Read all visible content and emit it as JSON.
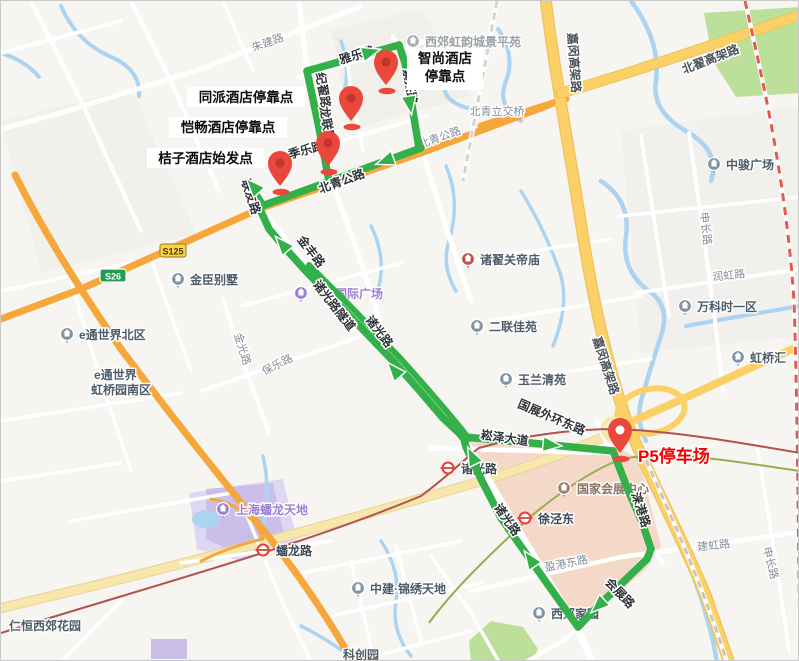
{
  "map_title": "hotel-shuttle-route-map",
  "route": {
    "color": "#33b04a",
    "width": 7.5,
    "lines": [
      {
        "name": "beiqing-gonglu-segment",
        "w": 7.5,
        "points": [
          [
            420,
            147
          ],
          [
            258,
            206
          ]
        ]
      },
      {
        "name": "start-stub",
        "w": 6.5,
        "points": [
          [
            262,
            204
          ],
          [
            248,
            181
          ]
        ]
      },
      {
        "name": "jizhai-road-segment",
        "w": 7.5,
        "points": [
          [
            328,
            180
          ],
          [
            317,
            122
          ],
          [
            306,
            70
          ]
        ]
      },
      {
        "name": "yale-road-segment",
        "w": 7.5,
        "points": [
          [
            306,
            70
          ],
          [
            398,
            44
          ]
        ]
      },
      {
        "name": "zixing-road-segment",
        "w": 7.5,
        "points": [
          [
            398,
            44
          ],
          [
            404,
            62
          ],
          [
            418,
            147
          ]
        ]
      },
      {
        "name": "zhuguang-corridor-down",
        "w": 7.5,
        "points": [
          [
            258,
            206
          ],
          [
            268,
            228
          ],
          [
            284,
            247
          ],
          [
            303,
            268
          ],
          [
            324,
            290
          ],
          [
            347,
            313
          ],
          [
            370,
            337
          ],
          [
            394,
            362
          ],
          [
            418,
            389
          ],
          [
            442,
            417
          ],
          [
            458,
            432
          ],
          [
            463,
            438
          ]
        ]
      },
      {
        "name": "zhuguang-corridor-parallel",
        "w": 6,
        "points": [
          [
            308,
            264
          ],
          [
            330,
            286
          ],
          [
            353,
            309
          ],
          [
            376,
            333
          ],
          [
            400,
            358
          ],
          [
            424,
            385
          ],
          [
            448,
            413
          ],
          [
            462,
            430
          ],
          [
            468,
            438
          ]
        ]
      },
      {
        "name": "songze-avenue-segment",
        "w": 7.5,
        "points": [
          [
            463,
            436
          ],
          [
            530,
            442
          ],
          [
            612,
            450
          ]
        ]
      },
      {
        "name": "laigang-road-segment",
        "w": 7.5,
        "points": [
          [
            612,
            450
          ],
          [
            627,
            489
          ],
          [
            641,
            521
          ],
          [
            650,
            548
          ]
        ]
      },
      {
        "name": "huizhan-road-segment",
        "w": 7.5,
        "points": [
          [
            650,
            548
          ],
          [
            646,
            558
          ],
          [
            618,
            585
          ],
          [
            595,
            607
          ],
          [
            577,
            626
          ]
        ]
      },
      {
        "name": "zhuguang-road-return",
        "w": 7.5,
        "points": [
          [
            577,
            626
          ],
          [
            550,
            588
          ],
          [
            526,
            554
          ],
          [
            500,
            517
          ],
          [
            480,
            478
          ],
          [
            465,
            446
          ],
          [
            463,
            438
          ]
        ]
      }
    ],
    "arrows": [
      {
        "x": 370,
        "y": 51,
        "rot": -16
      },
      {
        "x": 409,
        "y": 104,
        "rot": 81
      },
      {
        "x": 384,
        "y": 160,
        "rot": 160
      },
      {
        "x": 252,
        "y": 185,
        "rot": -132
      },
      {
        "x": 281,
        "y": 243,
        "rot": -131
      },
      {
        "x": 393,
        "y": 369,
        "rot": -131
      },
      {
        "x": 471,
        "y": 455,
        "rot": -116
      },
      {
        "x": 551,
        "y": 444,
        "rot": 6
      },
      {
        "x": 597,
        "y": 605,
        "rot": 137
      },
      {
        "x": 529,
        "y": 558,
        "rot": -125
      }
    ]
  },
  "pins": [
    {
      "id": "zhishang-hotel-pin",
      "x": 385,
      "y": 84,
      "white_center": false
    },
    {
      "id": "tongpai-hotel-pin",
      "x": 350,
      "y": 120,
      "white_center": false
    },
    {
      "id": "kaichang-hotel-pin",
      "x": 327,
      "y": 165,
      "white_center": false
    },
    {
      "id": "juzi-hotel-pin",
      "x": 279,
      "y": 185,
      "white_center": false
    },
    {
      "id": "p5-parking-pin",
      "x": 619,
      "y": 452,
      "white_center": true
    }
  ],
  "pin_color": "#e9483b",
  "pin_inner": "#c5342b",
  "stop_labels": [
    {
      "id": "tongpai",
      "lines": [
        "同派酒店停靠点"
      ],
      "x": 186,
      "y": 86,
      "w": 118,
      "h": 20
    },
    {
      "id": "kaichang",
      "lines": [
        "恺畅酒店停靠点"
      ],
      "x": 168,
      "y": 116,
      "w": 118,
      "h": 20
    },
    {
      "id": "juzi",
      "lines": [
        "桔子酒店始发点"
      ],
      "x": 146,
      "y": 147,
      "w": 117,
      "h": 20
    },
    {
      "id": "zhishang",
      "lines": [
        "智尚酒店",
        "停靠点"
      ],
      "x": 406,
      "y": 47,
      "w": 76,
      "h": 42
    }
  ],
  "parking_label": {
    "text": "P5停车场",
    "x": 637,
    "y": 461
  },
  "road_labels": [
    {
      "t": "雅乐路",
      "x": 357,
      "y": 58,
      "r": -16,
      "c": "dark"
    },
    {
      "t": "纪翟路",
      "x": 318,
      "y": 90,
      "r": 80,
      "c": "dark"
    },
    {
      "t": "龙联路",
      "x": 322,
      "y": 124,
      "r": 80,
      "c": "dark"
    },
    {
      "t": "紫兴路",
      "x": 405,
      "y": 86,
      "r": 81,
      "c": "dark"
    },
    {
      "t": "季乐路",
      "x": 306,
      "y": 153,
      "r": -15,
      "c": "dark"
    },
    {
      "t": "联友路",
      "x": 246,
      "y": 197,
      "r": 72,
      "c": "dark"
    },
    {
      "t": "北青公路",
      "x": 342,
      "y": 184,
      "r": -20,
      "c": "dark"
    },
    {
      "t": "金丰路",
      "x": 307,
      "y": 253,
      "r": 52,
      "c": "dark"
    },
    {
      "t": "诸光路隧道",
      "x": 330,
      "y": 307,
      "r": 52,
      "c": "dark"
    },
    {
      "t": "诸光路",
      "x": 375,
      "y": 333,
      "r": 52,
      "c": "dark"
    },
    {
      "t": "诸光路",
      "x": 503,
      "y": 521,
      "r": 55,
      "c": "dark"
    },
    {
      "t": "崧泽大道",
      "x": 503,
      "y": 441,
      "r": 8,
      "c": "dark"
    },
    {
      "t": "国展外环东路",
      "x": 549,
      "y": 420,
      "r": 23,
      "c": "dark"
    },
    {
      "t": "涞港路",
      "x": 636,
      "y": 510,
      "r": 72,
      "c": "dark"
    },
    {
      "t": "会展路",
      "x": 616,
      "y": 595,
      "r": 46,
      "c": "dark"
    },
    {
      "t": "嘉闵高架路",
      "x": 569,
      "y": 62,
      "r": 86,
      "c": "hw"
    },
    {
      "t": "嘉闵高架路",
      "x": 601,
      "y": 366,
      "r": 72,
      "c": "hw"
    },
    {
      "t": "北翟高架路",
      "x": 711,
      "y": 62,
      "r": -21,
      "c": "hw"
    },
    {
      "t": "朱建路",
      "x": 268,
      "y": 45,
      "r": -20,
      "c": "gray"
    },
    {
      "t": "北青公路",
      "x": 440,
      "y": 140,
      "r": -20,
      "c": "gray"
    },
    {
      "t": "北青立交桥",
      "x": 496,
      "y": 114,
      "r": 0,
      "c": "gray"
    },
    {
      "t": "保乐路",
      "x": 278,
      "y": 367,
      "r": -27,
      "c": "gray"
    },
    {
      "t": "金光路",
      "x": 238,
      "y": 349,
      "r": 73,
      "c": "gray"
    },
    {
      "t": "盈港东路",
      "x": 566,
      "y": 566,
      "r": -11,
      "c": "gray"
    },
    {
      "t": "建虹路",
      "x": 713,
      "y": 548,
      "r": -6,
      "c": "gray"
    },
    {
      "t": "申长路",
      "x": 701,
      "y": 228,
      "r": 83,
      "c": "gray"
    },
    {
      "t": "申长路",
      "x": 766,
      "y": 563,
      "r": 75,
      "c": "gray"
    },
    {
      "t": "润虹路",
      "x": 728,
      "y": 278,
      "r": -6,
      "c": "gray"
    }
  ],
  "pois": [
    {
      "t": "西郊虹韵城景平苑",
      "ix": 412,
      "iy": 40,
      "tx": 424,
      "ty": 45,
      "ic": "#a6adb3",
      "tc": "#9aa2a8",
      "icon": true
    },
    {
      "t": "中骏广场",
      "ix": 713,
      "iy": 163,
      "tx": 725,
      "ty": 168,
      "ic": "#8194a3",
      "tc": "#4d5d6a",
      "icon": true
    },
    {
      "t": "万科时一区",
      "ix": 684,
      "iy": 305,
      "tx": 696,
      "ty": 310,
      "ic": "#8194a3",
      "tc": "#4d5d6a",
      "icon": true
    },
    {
      "t": "虹桥汇",
      "ix": 737,
      "iy": 356,
      "tx": 749,
      "ty": 361,
      "ic": "#8194a3",
      "tc": "#4d5d6a",
      "icon": true
    },
    {
      "t": "金臣别墅",
      "ix": 177,
      "iy": 278,
      "tx": 189,
      "ty": 283,
      "ic": "#8194a3",
      "tc": "#4d5d6a",
      "icon": true
    },
    {
      "t": "e通世界北区",
      "ix": 66,
      "iy": 333,
      "tx": 78,
      "ty": 338,
      "ic": "#8194a3",
      "tc": "#4d5d6a",
      "icon": true
    },
    {
      "t": "e通世界",
      "ix": 0,
      "iy": 0,
      "tx": 93,
      "ty": 378,
      "ic": "#8194a3",
      "tc": "#4d5d6a",
      "icon": false
    },
    {
      "t": "虹桥园南区",
      "ix": 0,
      "iy": 0,
      "tx": 90,
      "ty": 393,
      "ic": "#8194a3",
      "tc": "#4d5d6a",
      "icon": false
    },
    {
      "t": "诸翟关帝庙",
      "ix": 467,
      "iy": 258,
      "tx": 479,
      "ty": 263,
      "ic": "#c05048",
      "tc": "#4d5d6a",
      "icon": true
    },
    {
      "t": "国际广场",
      "ix": 300,
      "iy": 292,
      "tx": 334,
      "ty": 297,
      "ic": "#9b7fd4",
      "tc": "#9b7fd4",
      "icon": true
    },
    {
      "t": "二联佳苑",
      "ix": 476,
      "iy": 325,
      "tx": 488,
      "ty": 330,
      "ic": "#8194a3",
      "tc": "#4d5d6a",
      "icon": true
    },
    {
      "t": "玉兰清苑",
      "ix": 505,
      "iy": 378,
      "tx": 517,
      "ty": 383,
      "ic": "#8194a3",
      "tc": "#4d5d6a",
      "icon": true
    },
    {
      "t": "国家会展中心",
      "ix": 563,
      "iy": 487,
      "tx": 576,
      "ty": 492,
      "ic": "#9c8577",
      "tc": "#8a7164",
      "icon": true
    },
    {
      "t": "上海蟠龙天地",
      "ix": 222,
      "iy": 508,
      "tx": 235,
      "ty": 513,
      "ic": "#9b7fd4",
      "tc": "#9b7fd4",
      "icon": true
    },
    {
      "t": "中建·锦绣天地",
      "ix": 357,
      "iy": 587,
      "tx": 369,
      "ty": 592,
      "ic": "#8194a3",
      "tc": "#4d5d6a",
      "icon": true
    },
    {
      "t": "西郊家园",
      "ix": 538,
      "iy": 612,
      "tx": 550,
      "ty": 617,
      "ic": "#8194a3",
      "tc": "#4d5d6a",
      "icon": true
    },
    {
      "t": "仁恒西郊花园",
      "ix": 0,
      "iy": 0,
      "tx": 8,
      "ty": 629,
      "ic": "#8194a3",
      "tc": "#4d5d6a",
      "icon": false
    },
    {
      "t": "科创园",
      "ix": 0,
      "iy": 0,
      "tx": 342,
      "ty": 658,
      "ic": "#8194a3",
      "tc": "#4d5d6a",
      "icon": false
    }
  ],
  "stations": [
    {
      "t": "诸光路",
      "x": 447,
      "y": 467,
      "tx": 460,
      "ty": 472
    },
    {
      "t": "徐泾东",
      "x": 524,
      "y": 517,
      "tx": 537,
      "ty": 522
    },
    {
      "t": "蟠龙路",
      "x": 262,
      "y": 549,
      "tx": 275,
      "ty": 554
    }
  ],
  "station_color": "#e4403a",
  "badges": [
    {
      "t": "S125",
      "x": 172,
      "y": 250,
      "bg": "#fbd24b",
      "fg": "#4a3b00",
      "border": "#a98d1f"
    },
    {
      "t": "S26",
      "x": 112,
      "y": 275,
      "bg": "#1f9e4d",
      "fg": "#ffffff",
      "border": "#ffffff"
    }
  ]
}
